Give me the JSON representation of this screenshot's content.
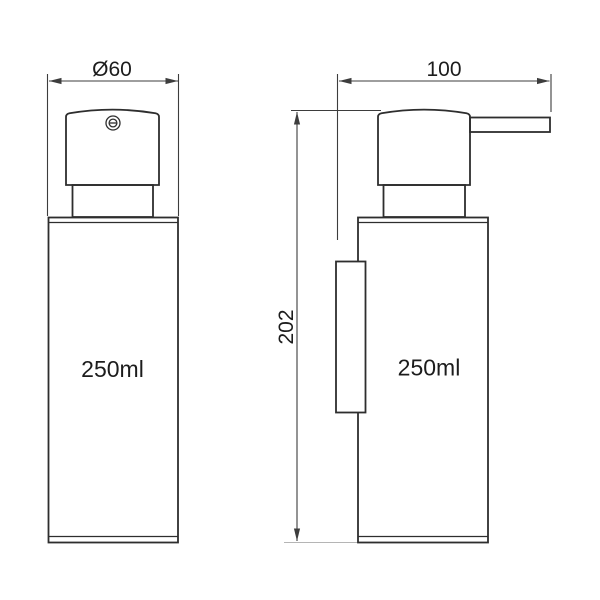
{
  "drawing": {
    "front_view": {
      "diameter_label": "Ø60",
      "capacity_label": "250ml"
    },
    "side_view": {
      "width_label": "100",
      "height_label": "202",
      "capacity_label": "250ml"
    },
    "icons": {
      "pump_cap": "circled-minus-icon"
    },
    "colors": {
      "background": "#ffffff",
      "outline": "#2e2e2e",
      "dimension": "#3d3d3d",
      "text": "#1c1c1c",
      "light_extension": "#b5b5b5"
    }
  }
}
